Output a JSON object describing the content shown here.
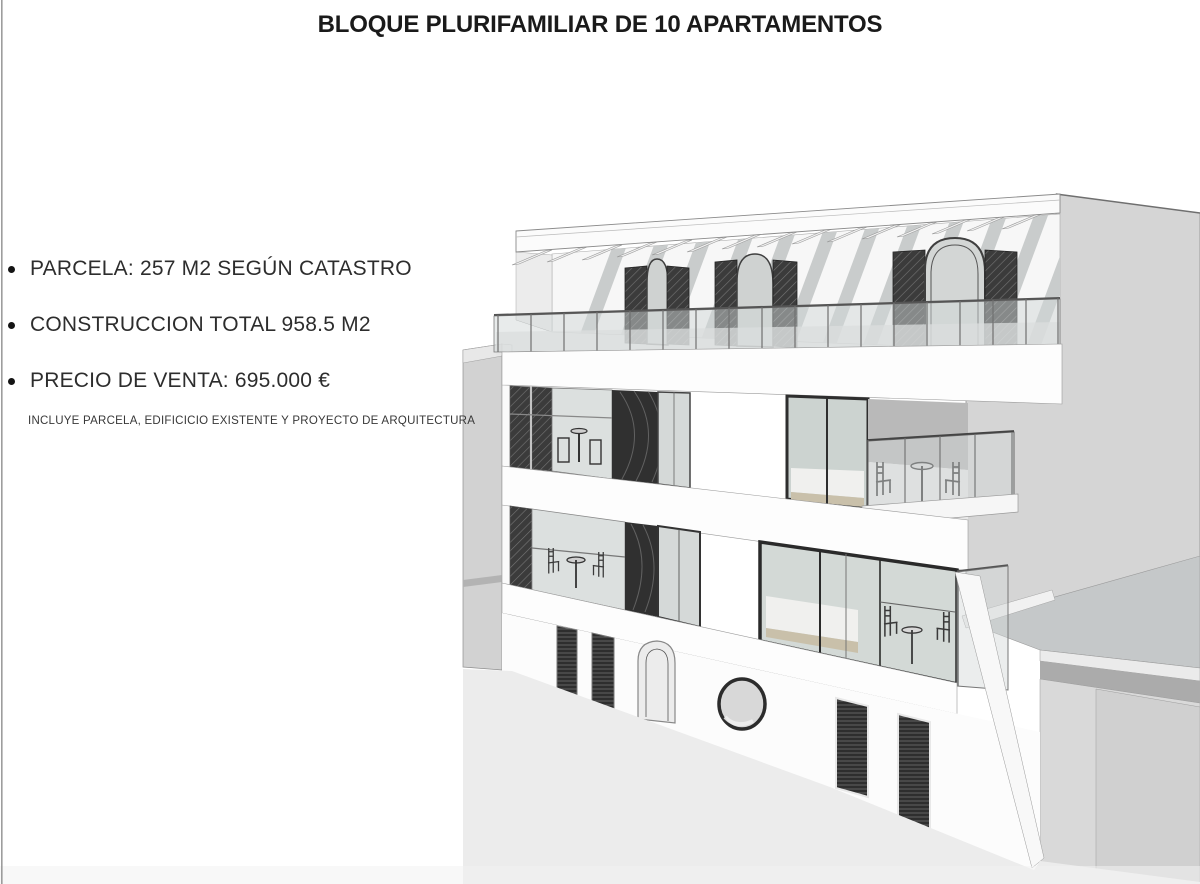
{
  "header": {
    "title": "BLOQUE PLURIFAMILIAR DE 10 APARTAMENTOS"
  },
  "details": [
    {
      "text": "PARCELA: 257 M2 SEGÚN CATASTRO"
    },
    {
      "text": "CONSTRUCCION TOTAL 958.5 M2"
    },
    {
      "text": "PRECIO DE VENTA: 695.000 €"
    }
  ],
  "note": {
    "text": "INCLUYE PARCELA, EDIFICICIO EXISTENTE Y PROYECTO DE ARQUITECTURA"
  },
  "illustration": {
    "label": "3D render of white 4-storey apartment block: roof terrace with pergola and three arched openings with dark lattice shutters, glass balustrade, two floors of balconies with tables and chairs, ground floor with arched door, porthole window and dark slatted windows, gray neighbouring buildings on both sides",
    "palette": {
      "wall_white": "#fcfcfc",
      "neighbor_gray": "#d5d5d5",
      "roof_gray": "#c5c8c9",
      "street_gray": "#ececec",
      "glass": "#d6dcd9",
      "dark_panel": "#343434",
      "frame_dark": "#2a2a2a",
      "wood_tan": "#c9c0aa",
      "text_dark": "#1a1a1a"
    }
  }
}
